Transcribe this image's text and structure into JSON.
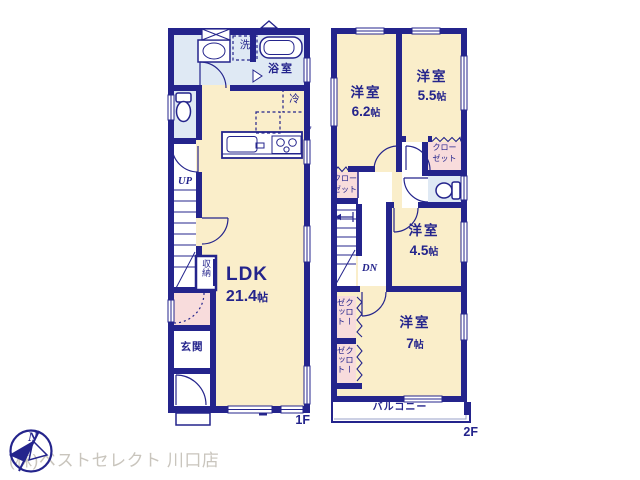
{
  "document_type": "real-estate floor plan",
  "colors": {
    "wall_navy": "#24248c",
    "room_cream": "#faeeca",
    "wet_area_blue": "#dfe9f4",
    "closet_pink": "#f8dcdc",
    "watermark_gray": "#c9c5bd"
  },
  "floor1": {
    "floor_tag": "1F",
    "meter_mark": "y",
    "rooms": {
      "washroom": {
        "washer_label": "洗"
      },
      "bathroom": {
        "label": "浴室"
      },
      "ldk": {
        "name": "LDK",
        "size_num": "21.4",
        "size_unit": "帖",
        "fridge_label": "冷"
      },
      "storage": {
        "label": "収納"
      },
      "stairs": {
        "label": "UP"
      },
      "entrance": {
        "label": "玄関"
      }
    }
  },
  "floor2": {
    "floor_tag": "2F",
    "closet": {
      "line1": "クロー",
      "line2": "ゼット"
    },
    "rooms": {
      "bedroom_6_2": {
        "name": "洋室",
        "size_num": "6.2",
        "size_unit": "帖"
      },
      "bedroom_5_5": {
        "name": "洋室",
        "size_num": "5.5",
        "size_unit": "帖"
      },
      "bedroom_4_5": {
        "name": "洋室",
        "size_num": "4.5",
        "size_unit": "帖"
      },
      "bedroom_7": {
        "name": "洋室",
        "size_num": "7",
        "size_unit": "帖"
      },
      "stairs": {
        "label": "DN"
      },
      "balcony": {
        "label": "バルコニー"
      }
    }
  },
  "watermark": {
    "north_label": "N",
    "company": "(株)ベストセレクト 川口店"
  }
}
